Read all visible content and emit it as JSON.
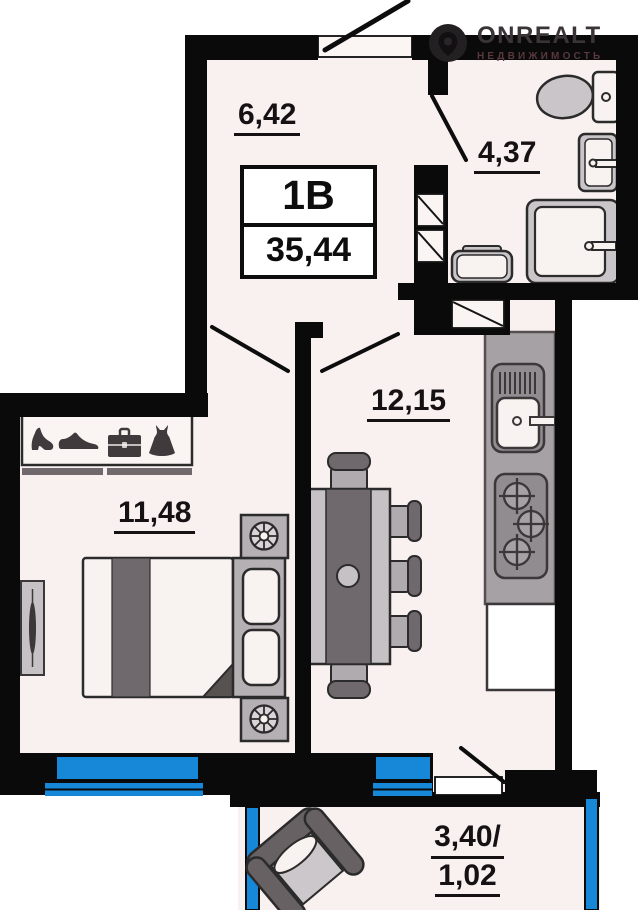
{
  "plan": {
    "unit_type": "1В",
    "total_area": "35,44",
    "rooms": {
      "hallway": "6,42",
      "bathroom": "4,37",
      "living_kitchen": "12,15",
      "bedroom": "11,48",
      "balcony_line1": "3,40/",
      "balcony_line2": "1,02"
    }
  },
  "watermark": {
    "brand": "ONREALT",
    "tagline": "НЕДВИЖИМОСТЬ"
  },
  "colors": {
    "wall": "#0a0a0a",
    "floor": "#f9f1f0",
    "window_blue": "#1788d8",
    "furniture_light": "#cac5c8",
    "furniture_mid": "#b5b0b3",
    "furniture_dark": "#6f696d",
    "counter_gray": "#a6a1a5"
  }
}
